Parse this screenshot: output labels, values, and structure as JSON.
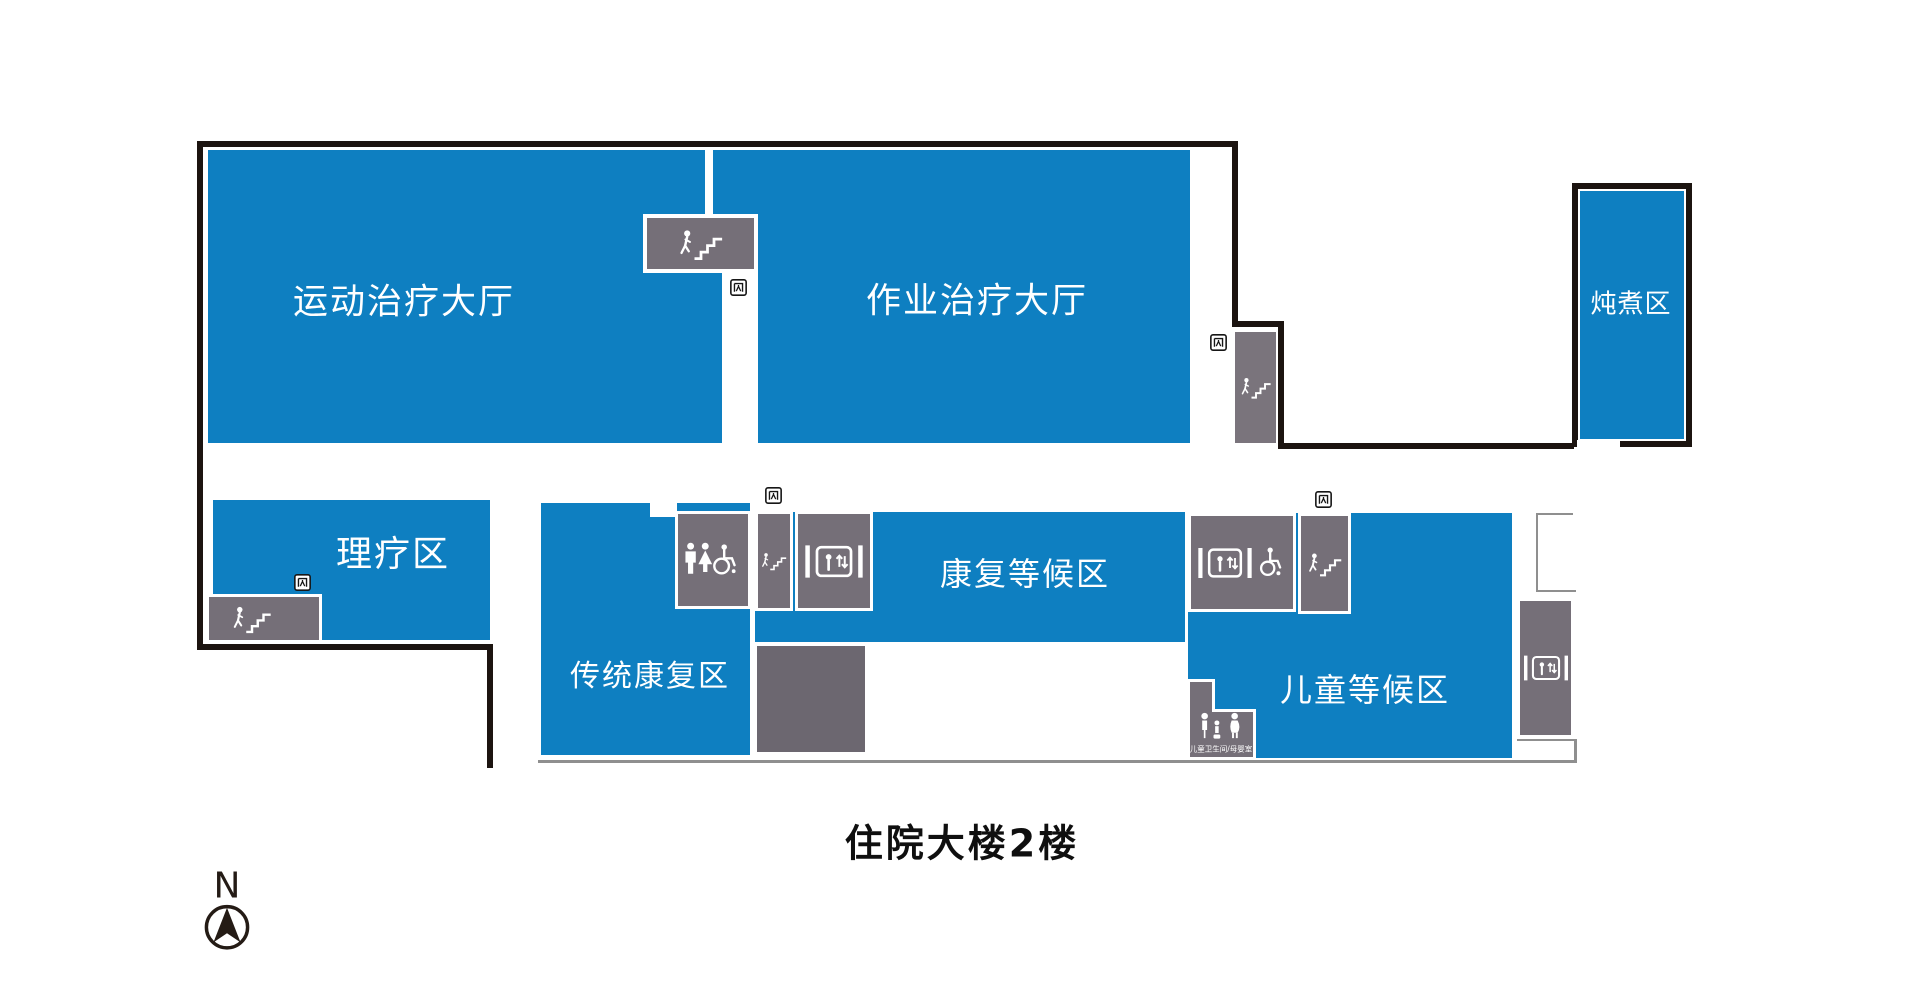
{
  "floor_title": "住院大楼2楼",
  "compass": {
    "north_label": "N"
  },
  "colors": {
    "room_blue": "#0e7fc1",
    "facility_gray": "#756f78",
    "unlabeled_gray": "#6c6770",
    "wall_black": "#1c1410",
    "outline_gray": "#8f8f8f"
  },
  "rooms": {
    "sports_therapy_hall": "运动治疗大厅",
    "occupational_therapy_hall": "作业治疗大厅",
    "stewing_area": "炖煮区",
    "physiotherapy_area": "理疗区",
    "traditional_rehab_area": "传统康复区",
    "rehab_waiting_area": "康复等候区",
    "children_waiting_area": "儿童等候区"
  },
  "facility_labels": {
    "children_restroom": "儿童卫生间/母婴室"
  },
  "facility_icons": [
    {
      "type": "stairs-icon",
      "location": "top-center-between-halls"
    },
    {
      "type": "stairs-icon",
      "location": "right-corridor"
    },
    {
      "type": "stairs-icon",
      "location": "physiotherapy-southwest"
    },
    {
      "type": "restroom-accessible-icon",
      "location": "center-band"
    },
    {
      "type": "stairs-icon",
      "location": "center-band"
    },
    {
      "type": "elevator-icon",
      "location": "center-band"
    },
    {
      "type": "elevator-wheelchair-icon",
      "location": "children-area-west"
    },
    {
      "type": "stairs-icon",
      "location": "children-area"
    },
    {
      "type": "elevator-icon",
      "location": "far-right"
    },
    {
      "type": "child-restroom-icon",
      "location": "children-area-south"
    },
    {
      "type": "exit-sign-icon",
      "location": "at-each-stairwell"
    }
  ]
}
